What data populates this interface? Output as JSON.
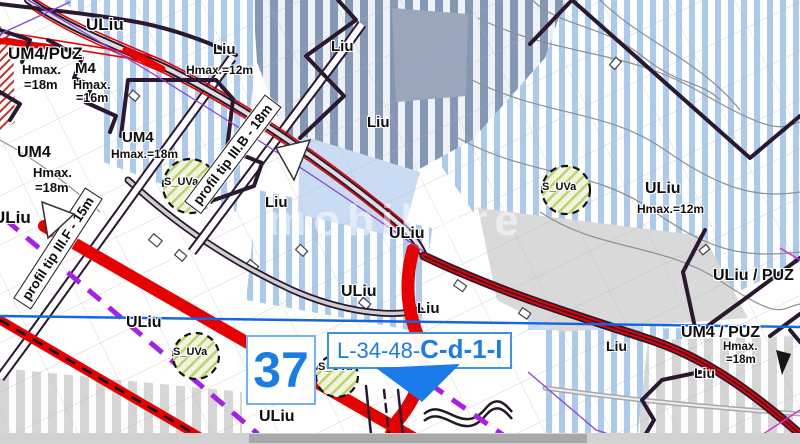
{
  "map": {
    "watermark": "imobiliare",
    "zones": {
      "uliu_nw": "ULiu",
      "um4_puz_nw": {
        "name": "UM4/PUZ",
        "hmax1": "Hmax.",
        "hmax2": "=18m"
      },
      "m4": {
        "name": "M4",
        "hmax1": "Hmax.",
        "hmax2": "=16m"
      },
      "liu_top": {
        "name": "Liu",
        "hmax": "Hmax.=12m"
      },
      "um4_center": {
        "name": "UM4",
        "hmax": "Hmax.=18m"
      },
      "um4_west": {
        "name": "UM4",
        "hmax1": "Hmax.",
        "hmax2": "=18m"
      },
      "liu_a": "Liu",
      "liu_b": "Liu",
      "liu_c": "Liu",
      "uliu_west": "ULiu",
      "uliu_center": "ULiu",
      "uliu_mid": "ULiu",
      "liu_mid": "Liu",
      "uliu_sw": "ULiu",
      "uliu_east": {
        "name": "ULiu",
        "hmax": "Hmax.=12m"
      },
      "uliu_puz_east": "ULiu / PUZ",
      "um4_puz_se": {
        "name": "UM4 / PUZ",
        "hmax1": "Hmax.",
        "hmax2": "=18m"
      },
      "liu_se_a": "Liu",
      "liu_se_b": "Liu",
      "uliu_bottom": "ULiu"
    },
    "green_area_label": "S_UVa",
    "road_profiles": {
      "profile_b": "profil tip III.B - 18m",
      "profile_f": "profil tip III.F - 15m"
    },
    "sheet": {
      "number": "37",
      "code_prefix": "L-34-48-",
      "code_suffix": "C-d-1-I"
    },
    "colors": {
      "accent_blue": "#1a7ce8",
      "road_red": "#e60000",
      "boundary_dark": "#2a1830",
      "dashed_purple": "#a81fe8",
      "section_line_blue": "#1567e0",
      "light_blue_stripe": "#abcaec",
      "dark_blue_stripe": "#8498b6",
      "gray_stripe": "#d6d6d6"
    }
  }
}
